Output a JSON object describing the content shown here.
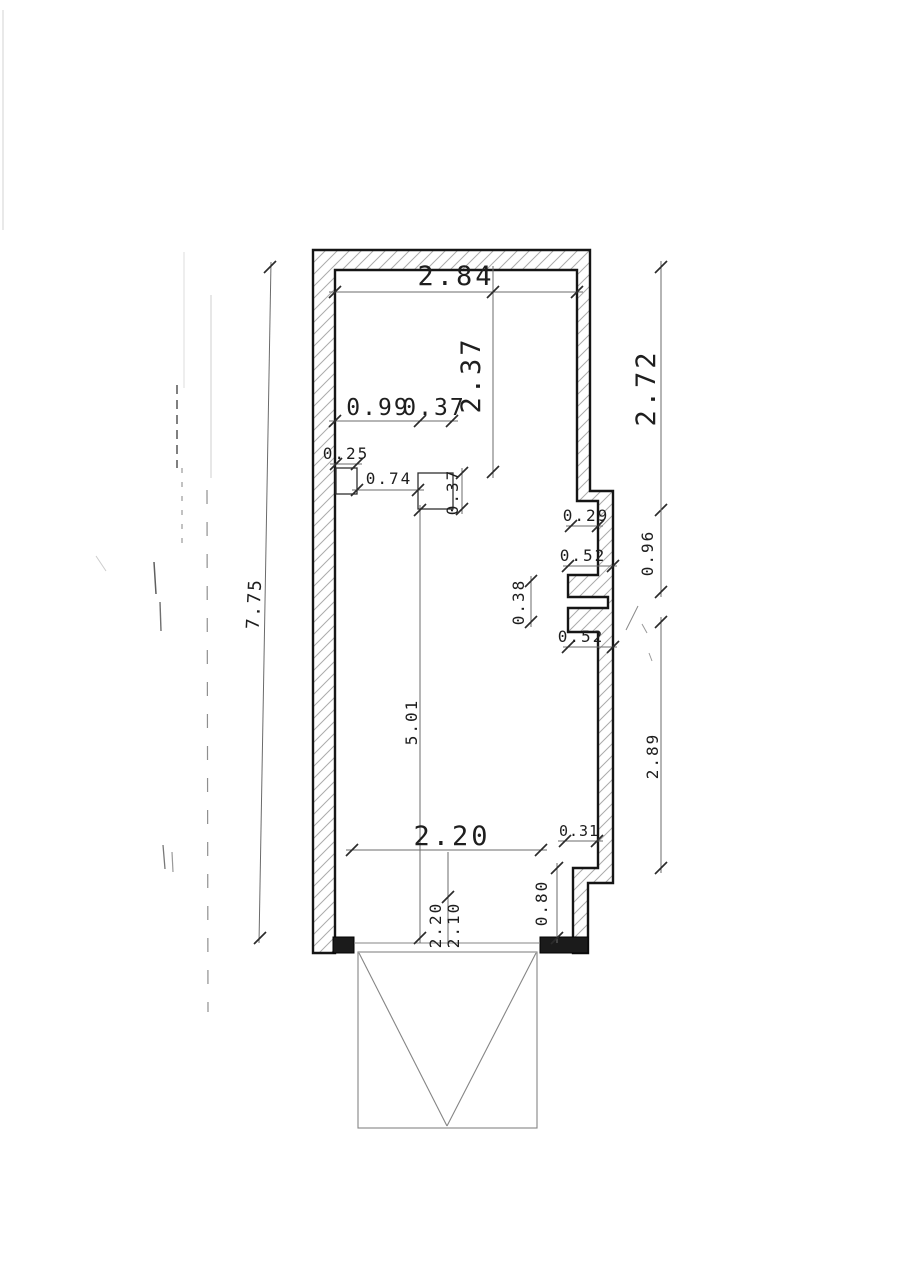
{
  "document": {
    "kind": "scanned floor plan (garage)",
    "background": "#ffffff",
    "ink": "#1a1a1a",
    "hatch_color": "#ababab",
    "dim_line_color": "#6b6b6b"
  },
  "drawing": {
    "dims": {
      "width_top": "2.84",
      "height_to_pillar": "2.37",
      "offset_left": "0.99",
      "pillar_width_top": "0.37",
      "niche_width": "0.25",
      "niche_to_pillar": "0.74",
      "pillar_depth": "0.37",
      "wall_step_right": "0.29",
      "joint_upper": "0.52",
      "joint_height": "0.38",
      "joint_lower": "0.52",
      "length_inner": "5.01",
      "height_total": "7.75",
      "right_upper": "2.72",
      "right_joint": "0.96",
      "right_lower": "2.89",
      "opening_width": "2.20",
      "jamb_step": "0.31",
      "jamb_depth": "0.80",
      "door_width": "2.20",
      "door_height": "2.10"
    }
  }
}
